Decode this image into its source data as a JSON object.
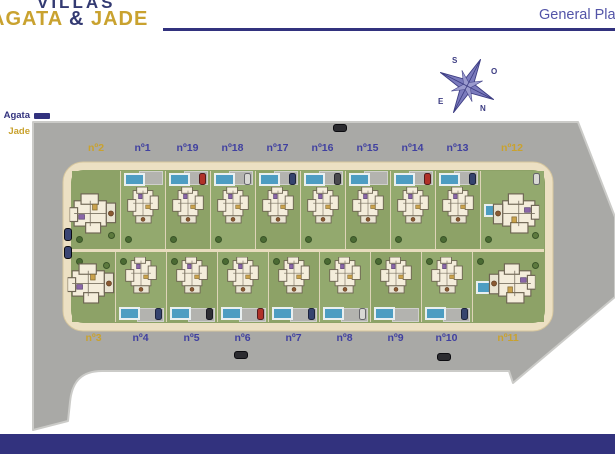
{
  "header": {
    "brand_line1": "VILLAS",
    "brand_agata": "AGATA",
    "brand_amp": "&",
    "brand_jade": "JADE",
    "title": "General Plan"
  },
  "legend": {
    "items": [
      {
        "label": "Agata",
        "color": "#32327e"
      },
      {
        "label": "Jade",
        "color": "#c9a22f"
      }
    ]
  },
  "compass": {
    "letters": {
      "n": "N",
      "s": "S",
      "e": "E",
      "o": "O"
    }
  },
  "plan": {
    "colors": {
      "road": "#a9a9a6",
      "curb": "#cbcbc8",
      "path": "#ece0c3",
      "grass": "#8da267",
      "pool": "#4d9dc2",
      "label_blue": "#4040a0",
      "label_gold": "#c9a22f"
    },
    "top_row": [
      {
        "label": "nº2",
        "collection": "jade",
        "car": null
      },
      {
        "label": "nº1",
        "collection": "agata",
        "car": null
      },
      {
        "label": "nº19",
        "collection": "agata",
        "car": "#b03228"
      },
      {
        "label": "nº18",
        "collection": "agata",
        "car": "#d8d8d4"
      },
      {
        "label": "nº17",
        "collection": "agata",
        "car": "#35436e"
      },
      {
        "label": "nº16",
        "collection": "agata",
        "car": "#4a4a4e"
      },
      {
        "label": "nº15",
        "collection": "agata",
        "car": null
      },
      {
        "label": "nº14",
        "collection": "agata",
        "car": "#b03228"
      },
      {
        "label": "nº13",
        "collection": "agata",
        "car": "#35436e"
      },
      {
        "label": "nº12",
        "collection": "jade",
        "car": "#d8d8d4"
      }
    ],
    "bottom_row": [
      {
        "label": "nº3",
        "collection": "jade",
        "car": null
      },
      {
        "label": "nº4",
        "collection": "agata",
        "car": "#35436e"
      },
      {
        "label": "nº5",
        "collection": "agata",
        "car": "#2e2e34"
      },
      {
        "label": "nº6",
        "collection": "agata",
        "car": "#b03228"
      },
      {
        "label": "nº7",
        "collection": "agata",
        "car": "#35436e"
      },
      {
        "label": "nº8",
        "collection": "agata",
        "car": "#d8d8d4"
      },
      {
        "label": "nº9",
        "collection": "agata",
        "car": null
      },
      {
        "label": "nº10",
        "collection": "agata",
        "car": "#35436e"
      },
      {
        "label": "nº11",
        "collection": "jade",
        "car": null
      }
    ],
    "road_cars": [
      {
        "color": "#2c2c30"
      },
      {
        "color": "#2c2c30"
      },
      {
        "color": "#2c2c30"
      }
    ],
    "path_cars": [
      {
        "color": "#3a4573"
      },
      {
        "color": "#3a4573"
      }
    ]
  }
}
